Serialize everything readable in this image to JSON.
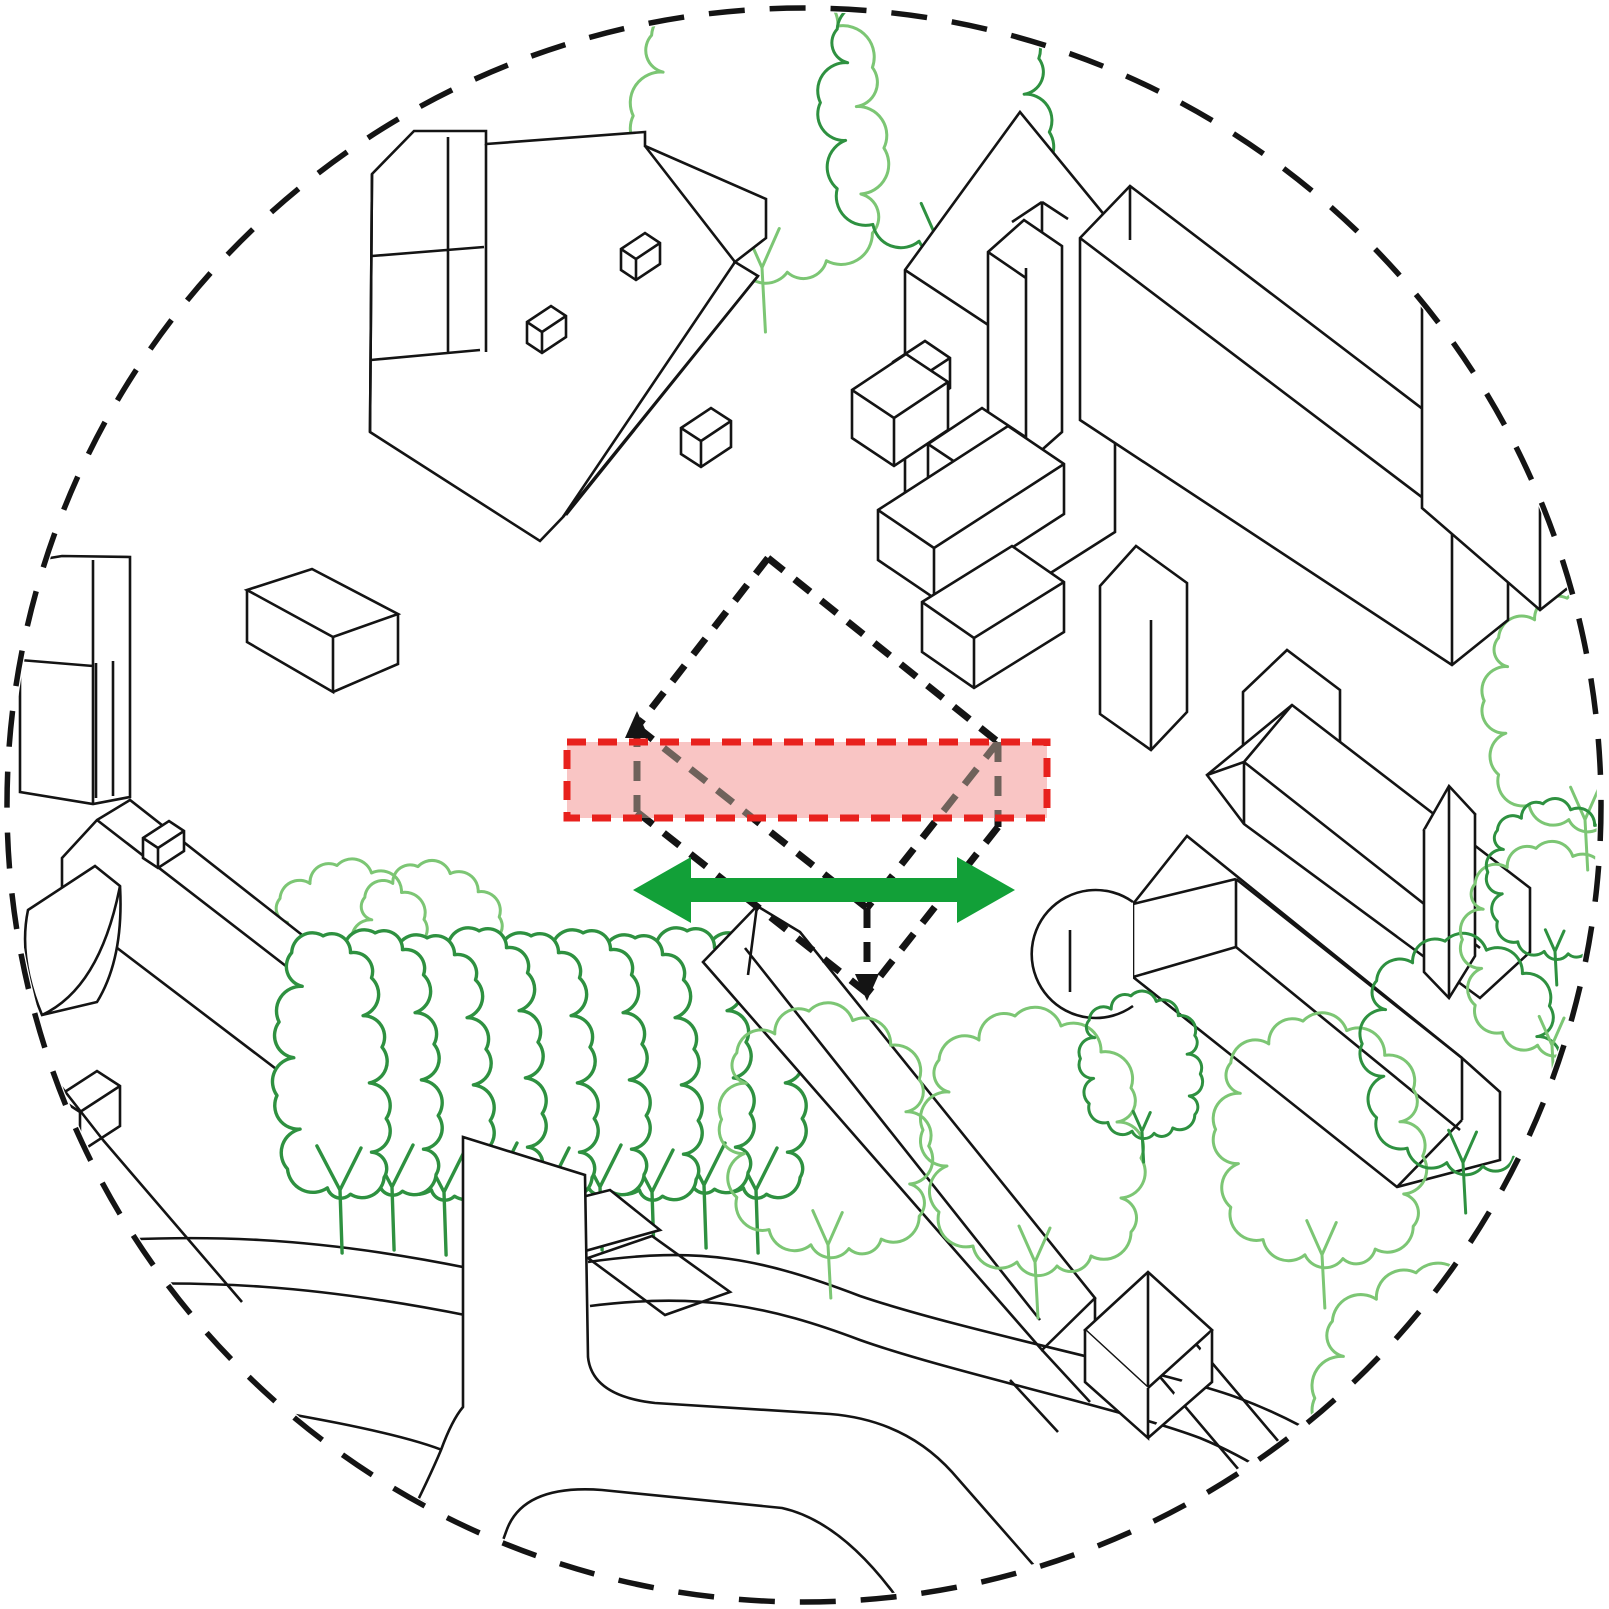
{
  "title": "axonometric-site-diagram",
  "canvas": {
    "w": 1609,
    "h": 1609
  },
  "colors": {
    "line": "#141414",
    "dash_black": "#141414",
    "dash_under_band": "#6F625B",
    "band_border": "#E8211D",
    "band_fill": "rgba(231,40,36,0.27)",
    "arrow_green": "#12A038",
    "tree_dark": "#2E9140",
    "tree_light": "#7CC674",
    "building_fill": "#FFFFFF"
  },
  "boundary_circle": {
    "cx": 804,
    "cy": 805,
    "r": 797,
    "clip_r": 793,
    "stroke_w": 5.5,
    "dash": "36 25"
  },
  "overlay": {
    "band": {
      "x": 567,
      "y": 742,
      "w": 480,
      "h": 76,
      "border_w": 7,
      "border_dash": "19 12"
    },
    "site_box_edges": "M768,558L637,727M768,558L998,742M637,727L867,908M998,742L867,908M637,727L637,812M998,742L998,827M867,908L867,993M637,812L867,993M998,827L867,993",
    "box_dash": "20 14",
    "box_w": 7,
    "arrow_up": "M637,711L625,738L649,738Z",
    "arrow_down": "M867,1001L855,974L879,974Z",
    "movement_arrow": "M633,890L691,857L691,878L957,878L957,857L1015,890L957,923L957,902L691,902L691,923Z"
  },
  "tree_templates": {
    "row": {
      "pts": [
        [
          -12,
          -62
        ],
        [
          -50,
          -80
        ],
        [
          -38,
          -118
        ],
        [
          -60,
          -150
        ],
        [
          -44,
          -186
        ],
        [
          -58,
          -220
        ],
        [
          -36,
          -254
        ],
        [
          -46,
          -286
        ],
        [
          -16,
          -302
        ],
        [
          10,
          -286
        ],
        [
          30,
          -262
        ],
        [
          22,
          -226
        ],
        [
          40,
          -196
        ],
        [
          28,
          -162
        ],
        [
          44,
          -128
        ],
        [
          30,
          -96
        ],
        [
          42,
          -72
        ],
        [
          10,
          -56
        ]
      ],
      "trunk": "M2,0L0,-60M0,-60L-22,-102M0,-60L20,-100",
      "sw": 3.4
    },
    "single": {
      "pts": [
        [
          -18,
          -56
        ],
        [
          -62,
          -72
        ],
        [
          -96,
          -106
        ],
        [
          -88,
          -152
        ],
        [
          -112,
          -188
        ],
        [
          -86,
          -226
        ],
        [
          -96,
          -258
        ],
        [
          -56,
          -278
        ],
        [
          -20,
          -302
        ],
        [
          26,
          -292
        ],
        [
          66,
          -266
        ],
        [
          96,
          -230
        ],
        [
          82,
          -196
        ],
        [
          106,
          -160
        ],
        [
          86,
          -120
        ],
        [
          96,
          -86
        ],
        [
          56,
          -62
        ],
        [
          22,
          -52
        ]
      ],
      "trunk": "M3,0L0,-56M0,-56L-16,-92M0,-56L15,-90",
      "sw": 3.0
    }
  },
  "shapes": [
    {
      "n": "tree-top-left-light",
      "tree": "single",
      "v": "light",
      "x": 762,
      "y": 332,
      "s": 1.15
    },
    {
      "n": "tree-top-right-dark",
      "tree": "single",
      "v": "dark",
      "x": 938,
      "y": 300,
      "s": 1.05
    },
    {
      "n": "tree-behind-row-1",
      "tree": "single",
      "v": "light",
      "x": 352,
      "y": 1092,
      "s": 0.75
    },
    {
      "n": "tree-behind-row-2",
      "tree": "single",
      "v": "light",
      "x": 432,
      "y": 1078,
      "s": 0.7
    },
    {
      "n": "tree-right-edge",
      "tree": "single",
      "v": "light",
      "x": 1585,
      "y": 870,
      "s": 0.9
    },
    {
      "n": "building-top-left",
      "d": "M372,174L414,131L486,131L486,144L645,132L645,146L766,199L766,238L735,262L758,276L563,517L540,541L370,432Z",
      "f": "#FFFFFF"
    },
    {
      "n": "building-top-left-lines",
      "d": "M372,174L370,432M372,256L484,247M371,360L480,350M486,144L486,352M448,137L448,354M645,146L735,262M735,262L563,517M758,276L566,515"
    },
    {
      "n": "chimney-1",
      "d": "M527,322l24,-16l15,10l0,21l-24,16l-15,-10Z",
      "f": "#FFFFFF"
    },
    {
      "n": "chimney-1-lines",
      "d": "M527,322l15,10M542,332l24,-16M542,332l0,21"
    },
    {
      "n": "chimney-2",
      "d": "M621,249l24,-16l15,10l0,21l-24,16l-15,-10Z",
      "f": "#FFFFFF"
    },
    {
      "n": "chimney-2-lines",
      "d": "M621,249l15,10M636,259l24,-16M636,259l0,21"
    },
    {
      "n": "dormer-1",
      "d": "M681,428l30,-20l20,13l0,26l-30,20l-20,-13Z",
      "f": "#FFFFFF"
    },
    {
      "n": "dormer-1-lines",
      "d": "M681,428l20,13M701,441l30,-20M701,441l0,26"
    },
    {
      "n": "tower-slab",
      "d": "M905,270L1020,112L1115,228L1115,532L1008,600L905,508Z",
      "f": "#FFFFFF"
    },
    {
      "n": "tower-slab-lines",
      "d": "M1008,338L1008,600M905,270L1008,338M1012,222l30,-20M1042,202l26,17M1042,202l0,50"
    },
    {
      "n": "chimney-slab",
      "d": "M988,252L1024,220L1062,246L1062,432L1026,464L988,438Z",
      "f": "#FFFFFF"
    },
    {
      "n": "chimney-slab-lines",
      "d": "M1026,268L1026,464M988,252L1026,278"
    },
    {
      "n": "deep-slab",
      "d": "M1080,238L1130,186L1508,474L1508,620L1452,665L1080,420Z",
      "f": "#FFFFFF"
    },
    {
      "n": "deep-slab-lines",
      "d": "M1080,238L1452,520M1452,520L1452,665M1130,186L1130,240"
    },
    {
      "n": "far-right-slab",
      "d": "M1422,304L1472,252L1603,352L1603,560L1540,610L1422,508Z",
      "f": "#FFFFFF"
    },
    {
      "n": "far-right-slab-lines",
      "d": "M1540,400L1540,610M1472,252L1472,300"
    },
    {
      "n": "box-small",
      "d": "M893,362l32,-21l25,17l0,30l-32,21l-25,-17Z",
      "f": "#FFFFFF"
    },
    {
      "n": "box-small-lines",
      "d": "M893,362l25,17M918,379l32,-21M918,379l0,30"
    },
    {
      "n": "box-1",
      "d": "M852,390l54,-36l42,28l0,48l-54,36l-42,-28Z",
      "f": "#FFFFFF"
    },
    {
      "n": "box-1-lines",
      "d": "M852,390l42,28M894,418l54,-36M894,418l0,48"
    },
    {
      "n": "box-2",
      "d": "M928,444l54,-36l42,28l0,48l-54,36l-42,-28Z",
      "f": "#FFFFFF"
    },
    {
      "n": "box-2-lines",
      "d": "M928,444l42,28M970,472l54,-36M970,472l0,48"
    },
    {
      "n": "low-long-box",
      "d": "M878,510L1008,426L1064,464L1064,514L934,598L878,560Z",
      "f": "#FFFFFF"
    },
    {
      "n": "low-long-box-lines",
      "d": "M878,510l56,38M934,548L1064,464M934,548l0,50"
    },
    {
      "n": "low-box-2",
      "d": "M922,602L1012,546L1064,582L1064,632L974,688L922,652Z",
      "f": "#FFFFFF"
    },
    {
      "n": "low-box-2-lines",
      "d": "M922,602l52,36M974,638L1064,582M974,638l0,50"
    },
    {
      "n": "thin-slab",
      "d": "M1100,586L1136,546L1187,583L1187,712L1151,750L1100,714Z",
      "f": "#FFFFFF"
    },
    {
      "n": "thin-slab-lines",
      "d": "M1151,620L1151,750"
    },
    {
      "n": "mid-slab",
      "d": "M1243,692L1287,650L1340,690L1340,742L1296,784L1243,744Z",
      "f": "#FFFFFF"
    },
    {
      "n": "mid-slab-lines",
      "d": "M1296,730L1296,784"
    },
    {
      "n": "left-slab",
      "d": "M20,563L62,556L130,557L130,797L93,804L20,792Z",
      "f": "#FFFFFF"
    },
    {
      "n": "left-slab-lines",
      "d": "M93,560L93,803M20,660L93,666M96,663L96,798M113,661L113,796"
    },
    {
      "n": "left-tower-roof",
      "d": "M247,590L312,569L398,614L333,637Z",
      "f": "#FFFFFF"
    },
    {
      "n": "left-tower-lines",
      "d": "M247,590L247,642L333,692L333,637M398,614L398,664L333,692M333,637L333,692"
    },
    {
      "n": "left-wing",
      "d": "M62,858L97,820L130,800L436,1040L436,1080L372,1142L62,906Z",
      "f": "#FFFFFF"
    },
    {
      "n": "left-wing-lines",
      "d": "M97,820L410,1062M436,1040L372,1142"
    },
    {
      "n": "left-chimney",
      "d": "M143,838l26,-17l15,10l0,20l-26,17l-15,-10Z",
      "f": "#FFFFFF"
    },
    {
      "n": "left-chimney-lines",
      "d": "M143,838l15,10M158,848l26,-17M158,848l0,20"
    },
    {
      "n": "left-curved-roof",
      "d": "M28,910L95,866L120,886Q124,958 97,1002L42,1015Q18,958 28,910Z",
      "f": "#FFFFFF"
    },
    {
      "n": "left-curved-lines",
      "d": "M42,1015Q100,988 120,886"
    },
    {
      "n": "left-lower-box",
      "d": "M57,1097l40,-26l23,15l0,40l-40,26l-23,-15Z",
      "f": "#FFFFFF"
    },
    {
      "n": "left-lower-box-lines",
      "d": "M57,1097l23,15M80,1112l40,-26M80,1112l0,40"
    },
    {
      "n": "left-lower-walls",
      "d": "M103,1140L242,1302M42,1062L103,1140"
    },
    {
      "n": "church-rear-hall",
      "d": "M1207,775L1292,705L1530,888L1530,952L1480,998L1244,824Z",
      "f": "#FFFFFF"
    },
    {
      "n": "church-rear-lines",
      "d": "M1244,762L1207,775M1244,762L1292,705M1244,762L1244,824M1244,762L1480,948"
    },
    {
      "n": "church-front-hall",
      "d": "M1133,904L1187,836L1462,1058L1500,1092L1500,1160L1397,1187L1133,977Z",
      "f": "#FFFFFF"
    },
    {
      "n": "church-front-lines",
      "d": "M1236,879L1236,947M1133,904L1236,879M1133,977L1236,947M1236,947L1460,1130M1462,1058L1462,1120M1462,1120L1397,1187M1236,879L1462,1058"
    },
    {
      "n": "church-apse",
      "d": "M1133,902A64,64 0 1 0 1133,1006",
      "f": "#FFFFFF"
    },
    {
      "n": "church-apse-line",
      "d": "M1070,930L1070,992"
    },
    {
      "n": "church-spire",
      "d": "M1424,830L1449,786L1475,814L1449,858Z",
      "f": "#FFFFFF"
    },
    {
      "n": "church-tower",
      "d": "M1424,830L1424,972L1449,998L1475,956L1475,814",
      "f": "#FFFFFF"
    },
    {
      "n": "church-tower-lines",
      "d": "M1449,786L1449,858M1449,858L1449,998"
    },
    {
      "n": "ramp-left-1",
      "d": "M20,1248C200,1228 330,1240 468,1268"
    },
    {
      "n": "ramp-left-2",
      "d": "M10,1292C200,1272 340,1290 470,1316"
    },
    {
      "n": "tree-row-9",
      "tree": "row",
      "v": "dark",
      "x": 756,
      "y": 1253,
      "s": 1.05
    },
    {
      "n": "tree-row-8",
      "tree": "row",
      "v": "dark",
      "x": 704,
      "y": 1248,
      "s": 1.05
    },
    {
      "n": "tree-row-7",
      "tree": "row",
      "v": "dark",
      "x": 652,
      "y": 1255,
      "s": 1.05
    },
    {
      "n": "tree-row-6",
      "tree": "row",
      "v": "dark",
      "x": 600,
      "y": 1250,
      "s": 1.05
    },
    {
      "n": "tree-row-5",
      "tree": "row",
      "v": "dark",
      "x": 548,
      "y": 1253,
      "s": 1.05
    },
    {
      "n": "tree-row-4",
      "tree": "row",
      "v": "dark",
      "x": 496,
      "y": 1248,
      "s": 1.05
    },
    {
      "n": "tree-row-3",
      "tree": "row",
      "v": "dark",
      "x": 444,
      "y": 1255,
      "s": 1.05
    },
    {
      "n": "tree-row-2",
      "tree": "row",
      "v": "dark",
      "x": 392,
      "y": 1250,
      "s": 1.05
    },
    {
      "n": "tree-row-1",
      "tree": "row",
      "v": "dark",
      "x": 340,
      "y": 1253,
      "s": 1.05
    },
    {
      "n": "bar-building",
      "d": "M703,962L757,906L800,932L1095,1298L1042,1350Z",
      "f": "#FFFFFF"
    },
    {
      "n": "bar-building-lines",
      "d": "M745,948L1040,1320M757,906L748,975M1095,1298L1095,1340"
    },
    {
      "n": "bar-extension-lines",
      "d": "M1042,1350L1090,1402M1010,1380L1058,1432"
    },
    {
      "n": "street-lines-right",
      "d": "M1105,1312L1300,1542M1152,1292L1345,1520"
    },
    {
      "n": "street-lines-corner",
      "d": "M1245,1609L1430,1448L1560,1566M1330,1609L1462,1492"
    },
    {
      "n": "ramp-plateau",
      "d": "M588,1258L652,1236L730,1292L665,1315Z",
      "f": "#FFFFFF"
    },
    {
      "n": "ramp-plateau-2",
      "d": "M510,1215L610,1190L660,1230L560,1258Z",
      "f": "#FFFFFF"
    },
    {
      "n": "ramp-right-upper",
      "d": "M588,1262C700,1246 760,1258 860,1296C960,1330 1150,1368 1230,1395C1330,1430 1420,1500 1470,1560L1480,1609"
    },
    {
      "n": "ramp-right-lower",
      "d": "M590,1306C700,1292 770,1306 860,1340C950,1372 1120,1408 1200,1438C1290,1475 1360,1540 1400,1609"
    },
    {
      "n": "ramp-lower-1",
      "d": "M150,1390C300,1415 400,1432 447,1452"
    },
    {
      "n": "ramp-lower-2",
      "d": "M95,1432C260,1468 380,1488 440,1505"
    },
    {
      "n": "ramp-lower-3",
      "d": "M45,1478C220,1520 350,1545 420,1560C450,1572 470,1590 478,1609"
    },
    {
      "n": "sculpture-wall",
      "d": "M463,1137L585,1175L588,1357Q592,1396 655,1403L830,1414Q905,1420 952,1472L1072,1609L905,1609Q845,1522 782,1508L602,1490Q522,1484 506,1532L478,1609L362,1609Q420,1500 441,1450Q452,1420 463,1407Z",
      "f": "#FFFFFF"
    },
    {
      "n": "hut",
      "d": "M1085,1330L1148,1272L1212,1330L1148,1388Z",
      "f": "#FFFFFF"
    },
    {
      "n": "hut-roof-lines",
      "d": "M1085,1330L1148,1388M1148,1272L1148,1388"
    },
    {
      "n": "hut-walls",
      "d": "M1085,1330L1085,1382L1148,1438L1148,1388M1212,1330L1212,1382L1148,1438",
      "f": "#FFFFFF"
    },
    {
      "n": "tree-front-1",
      "tree": "single",
      "v": "light",
      "x": 828,
      "y": 1298,
      "s": 0.95
    },
    {
      "n": "tree-front-2",
      "tree": "single",
      "v": "light",
      "x": 1035,
      "y": 1318,
      "s": 1.0
    },
    {
      "n": "tree-front-3",
      "tree": "single",
      "v": "light",
      "x": 1322,
      "y": 1308,
      "s": 0.95
    },
    {
      "n": "tree-front-4",
      "tree": "single",
      "v": "dark",
      "x": 1463,
      "y": 1213,
      "s": 0.9
    },
    {
      "n": "tree-front-5",
      "tree": "single",
      "v": "dark",
      "x": 1142,
      "y": 1162,
      "s": 0.55
    },
    {
      "n": "tree-front-6",
      "tree": "single",
      "v": "light",
      "x": 1552,
      "y": 1090,
      "s": 0.8
    },
    {
      "n": "tree-front-7",
      "tree": "single",
      "v": "dark",
      "x": 1555,
      "y": 985,
      "s": 0.6
    },
    {
      "n": "tree-front-8",
      "tree": "single",
      "v": "light",
      "x": 1438,
      "y": 1605,
      "s": 1.1
    }
  ]
}
